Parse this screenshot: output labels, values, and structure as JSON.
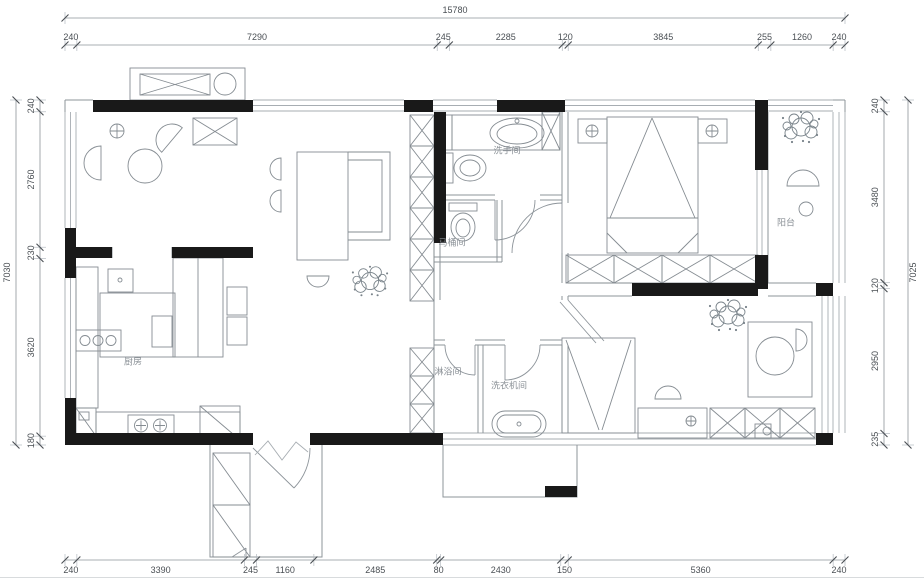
{
  "drawing": {
    "type": "floor-plan",
    "dimensions": {
      "top_total": [
        "15780"
      ],
      "top": [
        "240",
        "7290",
        "245",
        "2285",
        "120",
        "3845",
        "255",
        "1260",
        "240"
      ],
      "bottom": [
        "240",
        "3390",
        "245",
        "1160",
        "2485",
        "80",
        "2430",
        "150",
        "5360",
        "240"
      ],
      "left_total": [
        "7030"
      ],
      "left": [
        "240",
        "2760",
        "230",
        "3620",
        "180"
      ],
      "right": [
        "240",
        "3480",
        "120",
        "2950",
        "235"
      ],
      "right_total": [
        "7025"
      ]
    },
    "rooms": [
      {
        "id": "washroom",
        "label": "洗手间"
      },
      {
        "id": "toilet-room",
        "label": "马桶间"
      },
      {
        "id": "kitchen",
        "label": "厨房"
      },
      {
        "id": "shower-room",
        "label": "淋浴间"
      },
      {
        "id": "laundry-room",
        "label": "洗衣机间"
      },
      {
        "id": "balcony",
        "label": "阳台"
      }
    ],
    "colors": {
      "wall": "#191919",
      "thin_line": "#8d949a",
      "window_line": "#a7adb2",
      "dim_text": "#4a4f54",
      "label_text": "#8a9096",
      "background": "#ffffff"
    }
  }
}
